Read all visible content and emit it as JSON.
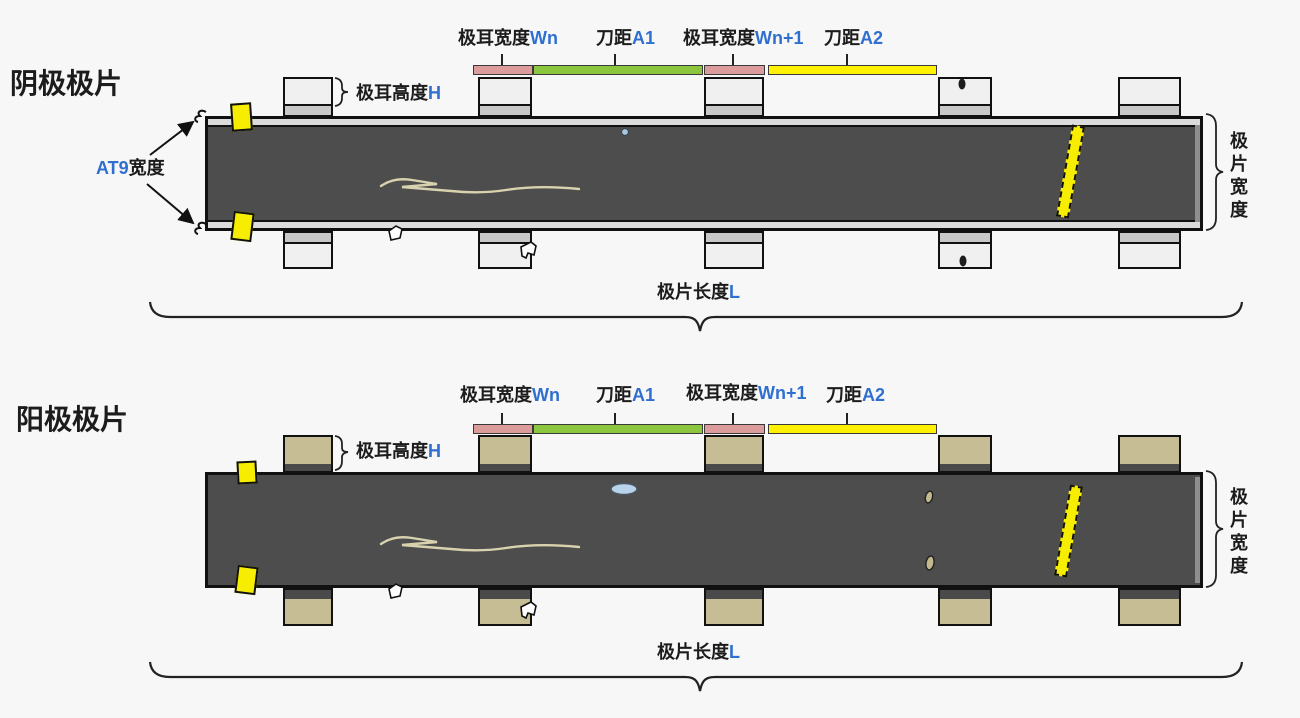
{
  "colors": {
    "background": "#f7f7f7",
    "accent_blue": "#2f6fd0",
    "tab_width_bar_pink": "#dc9c9c",
    "knife_a1_bar_green": "#8cc63e",
    "knife_a2_bar_yellow": "#fff100",
    "strip_dark_gray": "#4d4d4d",
    "cathode_tab_gray": "#f0f0f0",
    "anode_tab_tan": "#c6bd95",
    "alignment_mark_yellow": "#f7ed00"
  },
  "diagrams": [
    {
      "title": "阴极极片",
      "at9_label": {
        "var": "AT9",
        "zh": "宽度"
      },
      "tab_height": {
        "zh": "极耳高度",
        "var": "H"
      },
      "dims": [
        {
          "zh": "极耳宽度",
          "var": "Wn"
        },
        {
          "zh": "刀距",
          "var": "A1"
        },
        {
          "zh": "极耳宽度",
          "var": "Wn+1"
        },
        {
          "zh": "刀距",
          "var": "A2"
        }
      ],
      "strip_width": "极片宽度",
      "strip_length": {
        "zh": "极片长度",
        "var": "L"
      }
    },
    {
      "title": "阳极极片",
      "tab_height": {
        "zh": "极耳高度",
        "var": "H"
      },
      "dims": [
        {
          "zh": "极耳宽度",
          "var": "Wn"
        },
        {
          "zh": "刀距",
          "var": "A1"
        },
        {
          "zh": "极耳宽度",
          "var": "Wn+1"
        },
        {
          "zh": "刀距",
          "var": "A2"
        }
      ],
      "strip_width": "极片宽度",
      "strip_length": {
        "zh": "极片长度",
        "var": "L"
      }
    }
  ]
}
